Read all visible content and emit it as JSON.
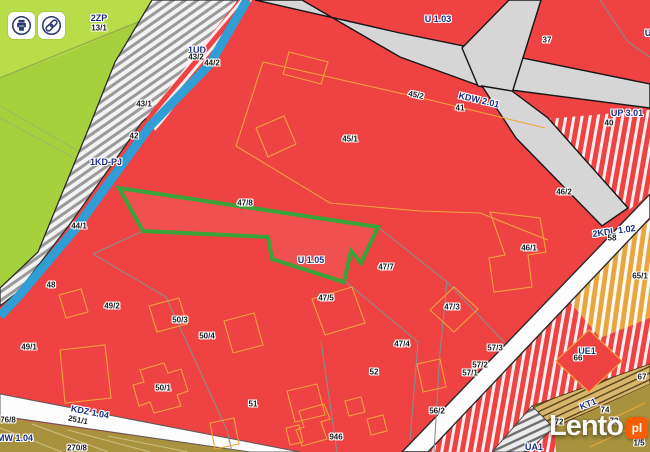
{
  "toolbar": {
    "icons": [
      {
        "name": "printer-icon"
      },
      {
        "name": "link-icon"
      }
    ]
  },
  "watermark": {
    "brand": "Lento",
    "tld": "pl",
    "badge_color": "#ff5a00"
  },
  "map": {
    "selected_parcel": "47/8",
    "colors": {
      "parcel_red": "#ef4242",
      "park_green": "#a6d13c",
      "park_green_light": "#b9dc49",
      "road_gray": "#d6d6d6",
      "road_white": "#fdfdfd",
      "waterline_blue": "#2f9ed6",
      "selection_green": "#3aa33a",
      "zone_label_navy": "#1e2f7f",
      "parcel_label_black": "#1b1b1b",
      "olive_zone": "#a8923d",
      "orange_outline": "#f0a43c",
      "tan_road": "#d7b56a",
      "watermark_orange": "#ff5a00"
    },
    "zone_labels": [
      {
        "text": "2ZP",
        "x": 99,
        "y": 18
      },
      {
        "text": "1UD",
        "x": 197,
        "y": 50
      },
      {
        "text": "U 1.03",
        "x": 438,
        "y": 19
      },
      {
        "text": "KDW 2.01",
        "x": 479,
        "y": 100,
        "rot": 13
      },
      {
        "text": "UP 3.01",
        "x": 627,
        "y": 113
      },
      {
        "text": "U",
        "x": 648,
        "y": 33
      },
      {
        "text": "1KD-PJ",
        "x": 106,
        "y": 162
      },
      {
        "text": "U 1.05",
        "x": 311,
        "y": 260
      },
      {
        "text": "2KDL 1.02",
        "x": 614,
        "y": 231,
        "rot": -8
      },
      {
        "text": "KDZ 1.04",
        "x": 90,
        "y": 412,
        "rot": 11
      },
      {
        "text": "MW 1.04",
        "x": 15,
        "y": 438
      },
      {
        "text": "UE1",
        "x": 587,
        "y": 351
      },
      {
        "text": "KT1",
        "x": 588,
        "y": 404,
        "rot": -22
      },
      {
        "text": "UA1",
        "x": 534,
        "y": 447
      }
    ],
    "parcel_labels": [
      {
        "text": "13/1",
        "x": 99,
        "y": 28
      },
      {
        "text": "43/2",
        "x": 196,
        "y": 57
      },
      {
        "text": "44/2",
        "x": 212,
        "y": 63
      },
      {
        "text": "43/1",
        "x": 144,
        "y": 104
      },
      {
        "text": "42",
        "x": 134,
        "y": 136
      },
      {
        "text": "37",
        "x": 547,
        "y": 40
      },
      {
        "text": "45/2",
        "x": 416,
        "y": 95,
        "rot": 12
      },
      {
        "text": "41",
        "x": 460,
        "y": 108
      },
      {
        "text": "40",
        "x": 609,
        "y": 123
      },
      {
        "text": "45/1",
        "x": 350,
        "y": 139
      },
      {
        "text": "44/1",
        "x": 79,
        "y": 226
      },
      {
        "text": "47/8",
        "x": 245,
        "y": 203
      },
      {
        "text": "46/2",
        "x": 564,
        "y": 192
      },
      {
        "text": "46/1",
        "x": 529,
        "y": 248
      },
      {
        "text": "58",
        "x": 612,
        "y": 238
      },
      {
        "text": "65/1",
        "x": 640,
        "y": 276
      },
      {
        "text": "47/7",
        "x": 386,
        "y": 267
      },
      {
        "text": "48",
        "x": 51,
        "y": 285
      },
      {
        "text": "47/5",
        "x": 326,
        "y": 298
      },
      {
        "text": "49/2",
        "x": 112,
        "y": 306
      },
      {
        "text": "47/3",
        "x": 452,
        "y": 307
      },
      {
        "text": "50/3",
        "x": 180,
        "y": 320
      },
      {
        "text": "50/4",
        "x": 207,
        "y": 336
      },
      {
        "text": "47/4",
        "x": 402,
        "y": 344
      },
      {
        "text": "49/1",
        "x": 29,
        "y": 347
      },
      {
        "text": "57/3",
        "x": 495,
        "y": 348
      },
      {
        "text": "66",
        "x": 578,
        "y": 358
      },
      {
        "text": "57/2",
        "x": 480,
        "y": 365
      },
      {
        "text": "52",
        "x": 374,
        "y": 372
      },
      {
        "text": "57/1",
        "x": 470,
        "y": 373
      },
      {
        "text": "67",
        "x": 642,
        "y": 377
      },
      {
        "text": "50/1",
        "x": 163,
        "y": 388
      },
      {
        "text": "51",
        "x": 253,
        "y": 404
      },
      {
        "text": "74",
        "x": 605,
        "y": 410
      },
      {
        "text": "56/2",
        "x": 437,
        "y": 411
      },
      {
        "text": "76/8",
        "x": 8,
        "y": 420
      },
      {
        "text": "251/1",
        "x": 78,
        "y": 420,
        "rot": 11
      },
      {
        "text": "73",
        "x": 614,
        "y": 421
      },
      {
        "text": "72",
        "x": 559,
        "y": 422
      },
      {
        "text": "946",
        "x": 336,
        "y": 437
      },
      {
        "text": "1/5",
        "x": 639,
        "y": 443
      },
      {
        "text": "270/8",
        "x": 77,
        "y": 448
      }
    ]
  }
}
